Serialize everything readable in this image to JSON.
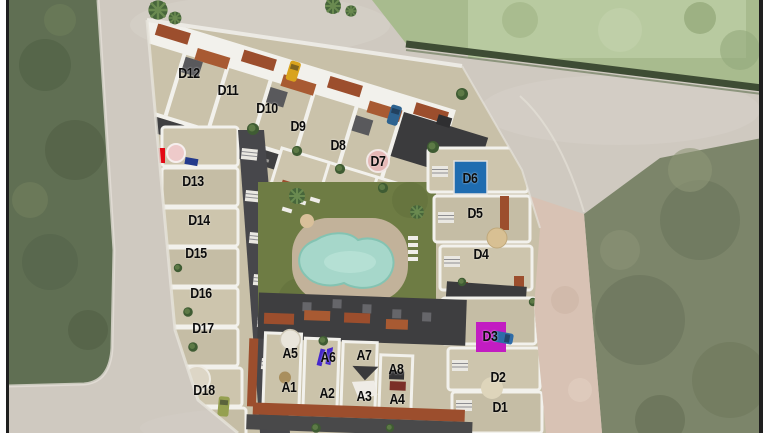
{
  "site": {
    "title": "Residential development aerial masterplan",
    "units": [
      {
        "id": "D12",
        "label": "D12",
        "x": 189,
        "y": 73
      },
      {
        "id": "D11",
        "label": "D11",
        "x": 228,
        "y": 90
      },
      {
        "id": "D10",
        "label": "D10",
        "x": 267,
        "y": 108
      },
      {
        "id": "D9",
        "label": "D9",
        "x": 298,
        "y": 126
      },
      {
        "id": "D8",
        "label": "D8",
        "x": 338,
        "y": 145
      },
      {
        "id": "D7",
        "label": "D7",
        "x": 378,
        "y": 161
      },
      {
        "id": "D13",
        "label": "D13",
        "x": 193,
        "y": 181
      },
      {
        "id": "D14",
        "label": "D14",
        "x": 199,
        "y": 220
      },
      {
        "id": "D15",
        "label": "D15",
        "x": 196,
        "y": 253
      },
      {
        "id": "D16",
        "label": "D16",
        "x": 201,
        "y": 293
      },
      {
        "id": "D17",
        "label": "D17",
        "x": 203,
        "y": 328
      },
      {
        "id": "D18",
        "label": "D18",
        "x": 204,
        "y": 390
      },
      {
        "id": "D6",
        "label": "D6",
        "x": 470,
        "y": 178
      },
      {
        "id": "D5",
        "label": "D5",
        "x": 475,
        "y": 213
      },
      {
        "id": "D4",
        "label": "D4",
        "x": 481,
        "y": 254
      },
      {
        "id": "D3",
        "label": "D3",
        "x": 490,
        "y": 336
      },
      {
        "id": "D2",
        "label": "D2",
        "x": 498,
        "y": 377
      },
      {
        "id": "D1",
        "label": "D1",
        "x": 500,
        "y": 407
      },
      {
        "id": "A5",
        "label": "A5",
        "x": 290,
        "y": 353
      },
      {
        "id": "A6",
        "label": "A6",
        "x": 328,
        "y": 357
      },
      {
        "id": "A7",
        "label": "A7",
        "x": 364,
        "y": 355
      },
      {
        "id": "A8",
        "label": "A8",
        "x": 396,
        "y": 369
      },
      {
        "id": "A1",
        "label": "A1",
        "x": 289,
        "y": 387
      },
      {
        "id": "A2",
        "label": "A2",
        "x": 327,
        "y": 393
      },
      {
        "id": "A3",
        "label": "A3",
        "x": 364,
        "y": 396
      },
      {
        "id": "A4",
        "label": "A4",
        "x": 397,
        "y": 399
      }
    ],
    "highlights": {
      "d6_pool_blue": "#1f6cb0",
      "d3_magenta": "#c21cc2",
      "entrance_red": "#e30914",
      "a6_purple": "#4526cc",
      "communal_pool": "#a6d7ca"
    }
  }
}
